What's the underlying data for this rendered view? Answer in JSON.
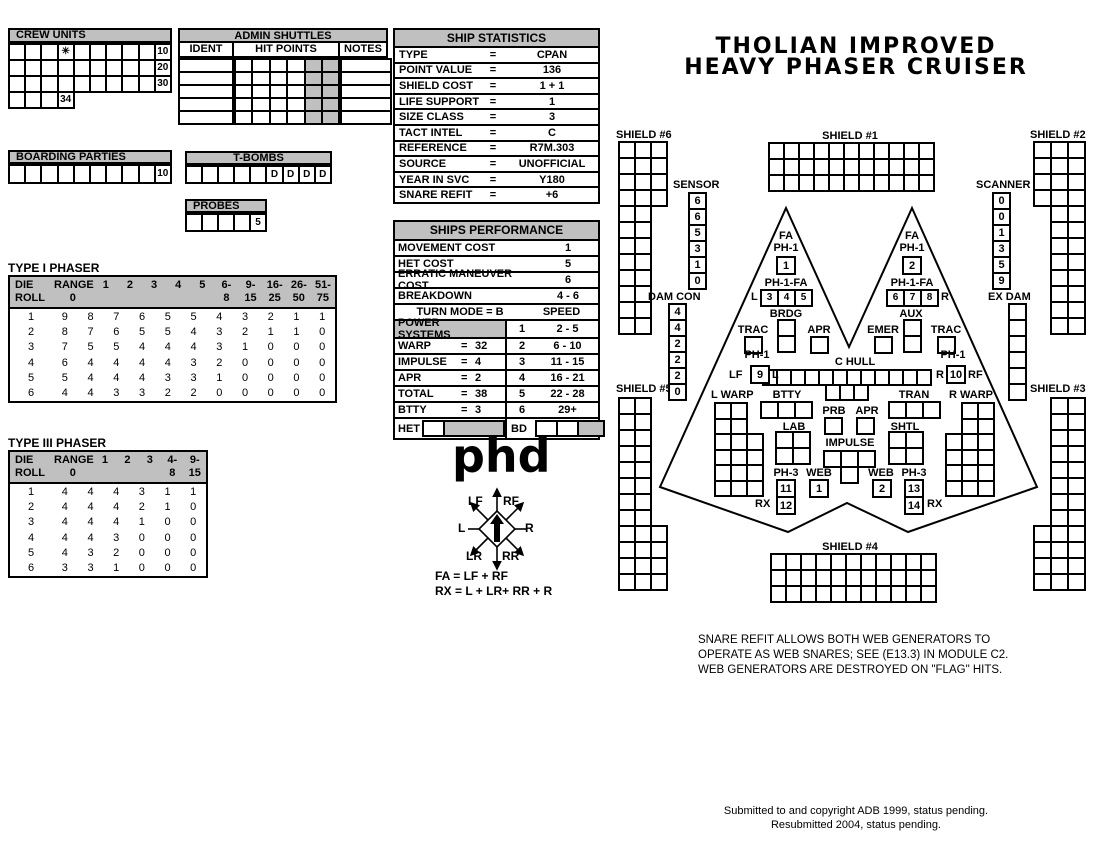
{
  "colors": {
    "panel_gray": "#c0c0c0",
    "ink": "#000000",
    "paper": "#ffffff"
  },
  "title": {
    "line1": "THOLIAN IMPROVED",
    "line2": "HEAVY PHASER CRUISER"
  },
  "crew_units": {
    "label": "CREW UNITS",
    "grid": [
      [
        "",
        "",
        "",
        "✳",
        "",
        "",
        "",
        "",
        "",
        "10"
      ],
      [
        "",
        "",
        "",
        "",
        "",
        "",
        "",
        "",
        "",
        "20"
      ],
      [
        "",
        "",
        "",
        "",
        "",
        "",
        "",
        "",
        "",
        "30"
      ],
      [
        "",
        "",
        "",
        "34"
      ]
    ]
  },
  "admin_shuttles": {
    "label": "ADMIN SHUTTLES",
    "col_ident": "IDENT",
    "col_hits": "HIT POINTS",
    "col_notes": "NOTES",
    "ident_grid": [
      [
        ""
      ],
      [
        ""
      ],
      [
        ""
      ],
      [
        ""
      ],
      [
        ""
      ]
    ],
    "hits_grid": [
      [
        "",
        "",
        "",
        "",
        "#",
        "#"
      ],
      [
        "",
        "",
        "",
        "",
        "#",
        "#"
      ],
      [
        "",
        "",
        "",
        "",
        "#",
        "#"
      ],
      [
        "",
        "",
        "",
        "",
        "#",
        "#"
      ],
      [
        "",
        "",
        "",
        "",
        "#",
        "#"
      ]
    ],
    "notes_grid": [
      [
        ""
      ],
      [
        ""
      ],
      [
        ""
      ],
      [
        ""
      ],
      [
        ""
      ]
    ]
  },
  "boarding_parties": {
    "label": "BOARDING PARTIES",
    "grid": [
      [
        "",
        "",
        "",
        "",
        "",
        "",
        "",
        "",
        "",
        "10"
      ]
    ]
  },
  "t_bombs": {
    "label": "T-BOMBS",
    "grid": [
      [
        "",
        "",
        "",
        "",
        "",
        "D",
        "D",
        "D",
        "D"
      ]
    ]
  },
  "probes": {
    "label": "PROBES",
    "grid": [
      [
        "",
        "",
        "",
        "",
        "5"
      ]
    ]
  },
  "ship_statistics": {
    "label": "SHIP STATISTICS",
    "rows": [
      {
        "label": "TYPE",
        "eq": "=",
        "value": "CPAN"
      },
      {
        "label": "POINT VALUE",
        "eq": "=",
        "value": "136"
      },
      {
        "label": "SHIELD COST",
        "eq": "=",
        "value": "1 + 1"
      },
      {
        "label": "LIFE SUPPORT",
        "eq": "=",
        "value": "1"
      },
      {
        "label": "SIZE CLASS",
        "eq": "=",
        "value": "3"
      },
      {
        "label": "TACT INTEL",
        "eq": "=",
        "value": "C"
      },
      {
        "label": "REFERENCE",
        "eq": "=",
        "value": "R7M.303"
      },
      {
        "label": "SOURCE",
        "eq": "=",
        "value": "UNOFFICIAL"
      },
      {
        "label": "YEAR IN SVC",
        "eq": "=",
        "value": "Y180"
      },
      {
        "label": "SNARE REFIT",
        "eq": "=",
        "value": "+6"
      }
    ]
  },
  "performance": {
    "label": "SHIPS PERFORMANCE",
    "simple_rows": [
      {
        "label": "MOVEMENT COST",
        "value": "1"
      },
      {
        "label": "HET COST",
        "value": "5"
      },
      {
        "label": "ERRATIC MANEUVER COST",
        "value": "6"
      },
      {
        "label": "BREAKDOWN",
        "value": "4 - 6"
      }
    ],
    "turn_mode": "TURN MODE = B",
    "speed_header": "SPEED",
    "power_rows": [
      {
        "label": "POWER SYSTEMS",
        "eq": "",
        "value": "",
        "gray": true
      },
      {
        "label": "WARP",
        "eq": "=",
        "value": "32"
      },
      {
        "label": "IMPULSE",
        "eq": "=",
        "value": "4"
      },
      {
        "label": "APR",
        "eq": "=",
        "value": "2"
      },
      {
        "label": "TOTAL",
        "eq": "=",
        "value": "38"
      },
      {
        "label": "BTTY",
        "eq": "=",
        "value": "3"
      }
    ],
    "speed_rows": [
      {
        "label": "1",
        "value": "2 - 5"
      },
      {
        "label": "2",
        "value": "6 - 10"
      },
      {
        "label": "3",
        "value": "11 - 15"
      },
      {
        "label": "4",
        "value": "16 - 21"
      },
      {
        "label": "5",
        "value": "22 - 28"
      },
      {
        "label": "6",
        "value": "29+"
      }
    ],
    "het_label": "HET",
    "bd_label": "BD",
    "het_cells": [
      [
        "",
        "#"
      ]
    ],
    "bd_cells": [
      [
        "",
        "",
        "#"
      ]
    ]
  },
  "phaser1": {
    "title": "TYPE I PHASER",
    "die_top": "DIE",
    "die_bot": "ROLL",
    "headers": [
      {
        "top": "RANGE",
        "bot": "0"
      },
      {
        "top": "",
        "bot": "1"
      },
      {
        "top": "",
        "bot": "2"
      },
      {
        "top": "",
        "bot": "3"
      },
      {
        "top": "",
        "bot": "4"
      },
      {
        "top": "",
        "bot": "5"
      },
      {
        "top": "6-",
        "bot": "8"
      },
      {
        "top": "9-",
        "bot": "15"
      },
      {
        "top": "16-",
        "bot": "25"
      },
      {
        "top": "26-",
        "bot": "50"
      },
      {
        "top": "51-",
        "bot": "75"
      }
    ],
    "rows": [
      [
        "1",
        "9",
        "8",
        "7",
        "6",
        "5",
        "5",
        "4",
        "3",
        "2",
        "1",
        "1"
      ],
      [
        "2",
        "8",
        "7",
        "6",
        "5",
        "5",
        "4",
        "3",
        "2",
        "1",
        "1",
        "0"
      ],
      [
        "3",
        "7",
        "5",
        "5",
        "4",
        "4",
        "4",
        "3",
        "1",
        "0",
        "0",
        "0"
      ],
      [
        "4",
        "6",
        "4",
        "4",
        "4",
        "4",
        "3",
        "2",
        "0",
        "0",
        "0",
        "0"
      ],
      [
        "5",
        "5",
        "4",
        "4",
        "4",
        "3",
        "3",
        "1",
        "0",
        "0",
        "0",
        "0"
      ],
      [
        "6",
        "4",
        "4",
        "3",
        "3",
        "2",
        "2",
        "0",
        "0",
        "0",
        "0",
        "0"
      ]
    ]
  },
  "phaser3": {
    "title": "TYPE III PHASER",
    "die_top": "DIE",
    "die_bot": "ROLL",
    "headers": [
      {
        "top": "RANGE",
        "bot": "0"
      },
      {
        "top": "",
        "bot": "1"
      },
      {
        "top": "",
        "bot": "2"
      },
      {
        "top": "",
        "bot": "3"
      },
      {
        "top": "4-",
        "bot": "8"
      },
      {
        "top": "9-",
        "bot": "15"
      }
    ],
    "rows": [
      [
        "1",
        "4",
        "4",
        "4",
        "3",
        "1",
        "1"
      ],
      [
        "2",
        "4",
        "4",
        "4",
        "2",
        "1",
        "0"
      ],
      [
        "3",
        "4",
        "4",
        "4",
        "1",
        "0",
        "0"
      ],
      [
        "4",
        "4",
        "4",
        "3",
        "0",
        "0",
        "0"
      ],
      [
        "5",
        "4",
        "3",
        "2",
        "0",
        "0",
        "0"
      ],
      [
        "6",
        "3",
        "3",
        "1",
        "0",
        "0",
        "0"
      ]
    ]
  },
  "phd": {
    "label": "phd",
    "fa_formula": "FA = LF + RF",
    "rx_formula": "RX = L + LR+ RR + R",
    "compass": {
      "lf": "LF",
      "rf": "RF",
      "l": "L",
      "r": "R",
      "lr": "LR",
      "rr": "RR"
    }
  },
  "diagram": {
    "shield1": {
      "label": "SHIELD #1",
      "grid": [
        [
          "",
          "",
          "",
          "",
          "",
          "",
          "",
          "",
          "",
          "",
          ""
        ],
        [
          "",
          "",
          "",
          "",
          "",
          "",
          "",
          "",
          "",
          "",
          ""
        ],
        [
          "",
          "",
          "",
          "",
          "",
          "",
          "",
          "",
          "",
          "",
          ""
        ]
      ]
    },
    "shield2": {
      "label": "SHIELD #2",
      "grid": [
        [
          "",
          "",
          ""
        ],
        [
          "",
          "",
          ""
        ],
        [
          "",
          "",
          ""
        ],
        [
          "",
          "",
          ""
        ],
        {
          "align": "right",
          "cells": [
            "",
            ""
          ]
        },
        {
          "align": "right",
          "cells": [
            "",
            ""
          ]
        },
        {
          "align": "right",
          "cells": [
            "",
            ""
          ]
        },
        {
          "align": "right",
          "cells": [
            "",
            ""
          ]
        },
        {
          "align": "right",
          "cells": [
            "",
            ""
          ]
        },
        {
          "align": "right",
          "cells": [
            "",
            ""
          ]
        },
        {
          "align": "right",
          "cells": [
            "",
            ""
          ]
        },
        {
          "align": "right",
          "cells": [
            "",
            ""
          ]
        }
      ]
    },
    "shield3": {
      "label": "SHIELD #3",
      "grid": [
        {
          "align": "right",
          "cells": [
            "",
            ""
          ]
        },
        {
          "align": "right",
          "cells": [
            "",
            ""
          ]
        },
        {
          "align": "right",
          "cells": [
            "",
            ""
          ]
        },
        {
          "align": "right",
          "cells": [
            "",
            ""
          ]
        },
        {
          "align": "right",
          "cells": [
            "",
            ""
          ]
        },
        {
          "align": "right",
          "cells": [
            "",
            ""
          ]
        },
        {
          "align": "right",
          "cells": [
            "",
            ""
          ]
        },
        {
          "align": "right",
          "cells": [
            "",
            ""
          ]
        },
        [
          "",
          "",
          ""
        ],
        [
          "",
          "",
          ""
        ],
        [
          "",
          "",
          ""
        ],
        [
          "",
          "",
          ""
        ]
      ]
    },
    "shield4": {
      "label": "SHIELD #4",
      "grid": [
        [
          "",
          "",
          "",
          "",
          "",
          "",
          "",
          "",
          "",
          "",
          ""
        ],
        [
          "",
          "",
          "",
          "",
          "",
          "",
          "",
          "",
          "",
          "",
          ""
        ],
        [
          "",
          "",
          "",
          "",
          "",
          "",
          "",
          "",
          "",
          "",
          ""
        ]
      ]
    },
    "shield5": {
      "label": "SHIELD #5",
      "grid": [
        [
          "",
          ""
        ],
        [
          "",
          ""
        ],
        [
          "",
          ""
        ],
        [
          "",
          ""
        ],
        [
          "",
          ""
        ],
        [
          "",
          ""
        ],
        [
          "",
          ""
        ],
        [
          "",
          ""
        ],
        [
          "",
          "",
          ""
        ],
        [
          "",
          "",
          ""
        ],
        [
          "",
          "",
          ""
        ],
        [
          "",
          "",
          ""
        ]
      ]
    },
    "shield6": {
      "label": "SHIELD #6",
      "grid": [
        [
          "",
          "",
          ""
        ],
        [
          "",
          "",
          ""
        ],
        [
          "",
          "",
          ""
        ],
        [
          "",
          "",
          ""
        ],
        [
          "",
          ""
        ],
        [
          "",
          ""
        ],
        [
          "",
          ""
        ],
        [
          "",
          ""
        ],
        [
          "",
          ""
        ],
        [
          "",
          ""
        ],
        [
          "",
          ""
        ],
        [
          "",
          ""
        ]
      ]
    },
    "sensor": {
      "label": "SENSOR",
      "grid": [
        [
          "6"
        ],
        [
          "6"
        ],
        [
          "5"
        ],
        [
          "3"
        ],
        [
          "1"
        ],
        [
          "0"
        ]
      ]
    },
    "scanner": {
      "label": "SCANNER",
      "grid": [
        [
          "0"
        ],
        [
          "0"
        ],
        [
          "1"
        ],
        [
          "3"
        ],
        [
          "5"
        ],
        [
          "9"
        ]
      ]
    },
    "dam_con": {
      "label": "DAM CON",
      "grid": [
        [
          "4"
        ],
        [
          "4"
        ],
        [
          "2"
        ],
        [
          "2"
        ],
        [
          "2"
        ],
        [
          "0"
        ]
      ]
    },
    "ex_dam": {
      "label": "EX DAM",
      "grid": [
        [
          ""
        ],
        [
          ""
        ],
        [
          ""
        ],
        [
          ""
        ],
        [
          ""
        ],
        [
          ""
        ]
      ]
    },
    "fa_left": {
      "label1": "FA",
      "label2": "PH-1",
      "grid": [
        [
          "1"
        ]
      ]
    },
    "fa_right": {
      "label1": "FA",
      "label2": "PH-1",
      "grid": [
        [
          "2"
        ]
      ]
    },
    "ph1fa_left": {
      "label": "PH-1-FA",
      "side": "L",
      "grid": [
        [
          "3",
          "4",
          "5"
        ]
      ]
    },
    "ph1fa_right": {
      "label": "PH-1-FA",
      "side": "R",
      "grid": [
        [
          "6",
          "7",
          "8"
        ]
      ]
    },
    "brdg": {
      "label": "BRDG",
      "grid": [
        [
          ""
        ],
        [
          ""
        ]
      ]
    },
    "aux": {
      "label": "AUX",
      "grid": [
        [
          ""
        ],
        [
          ""
        ]
      ]
    },
    "trac_left": {
      "label": "TRAC",
      "grid": [
        [
          ""
        ]
      ]
    },
    "trac_right": {
      "label": "TRAC",
      "grid": [
        [
          ""
        ]
      ]
    },
    "apr_top": {
      "label": "APR",
      "grid": [
        [
          ""
        ]
      ]
    },
    "emer": {
      "label": "EMER",
      "grid": [
        [
          ""
        ]
      ]
    },
    "c_hull": {
      "label": "C HULL",
      "grid": [
        [
          "",
          "",
          "",
          "",
          "",
          "",
          "",
          "",
          "",
          "",
          "",
          ""
        ],
        {
          "align": "center",
          "cells": [
            "",
            "",
            ""
          ]
        }
      ]
    },
    "ph1_waist_left": {
      "label": "PH-1",
      "pre": "LF",
      "post": "L",
      "grid": [
        [
          "9"
        ]
      ]
    },
    "ph1_waist_right": {
      "label": "PH-1",
      "pre": "R",
      "post": "RF",
      "grid": [
        [
          "10"
        ]
      ]
    },
    "l_warp": {
      "label": "L WARP",
      "grid": [
        [
          "",
          ""
        ],
        [
          "",
          ""
        ],
        [
          "",
          "",
          ""
        ],
        [
          "",
          "",
          ""
        ],
        [
          "",
          "",
          ""
        ],
        [
          "",
          "",
          ""
        ]
      ]
    },
    "r_warp": {
      "label": "R WARP",
      "grid": [
        {
          "align": "right",
          "cells": [
            "",
            ""
          ]
        },
        {
          "align": "right",
          "cells": [
            "",
            ""
          ]
        },
        [
          "",
          "",
          ""
        ],
        [
          "",
          "",
          ""
        ],
        [
          "",
          "",
          ""
        ],
        [
          "",
          "",
          ""
        ]
      ]
    },
    "btty": {
      "label": "BTTY",
      "grid": [
        [
          "",
          "",
          ""
        ]
      ]
    },
    "tran": {
      "label": "TRAN",
      "grid": [
        [
          "",
          "",
          ""
        ]
      ]
    },
    "lab": {
      "label": "LAB",
      "grid": [
        [
          "",
          ""
        ],
        [
          "",
          ""
        ]
      ]
    },
    "shtl": {
      "label": "SHTL",
      "grid": [
        [
          "",
          ""
        ],
        [
          "",
          ""
        ]
      ]
    },
    "prb": {
      "label": "PRB",
      "grid": [
        [
          ""
        ]
      ]
    },
    "apr_bottom": {
      "label": "APR",
      "grid": [
        [
          ""
        ]
      ]
    },
    "impulse": {
      "label": "IMPULSE",
      "grid": [
        [
          "",
          "",
          ""
        ],
        {
          "align": "center",
          "cells": [
            ""
          ]
        }
      ]
    },
    "ph3_left": {
      "label": "PH-3",
      "rx": "RX",
      "grid": [
        [
          "11"
        ],
        [
          "12"
        ]
      ]
    },
    "ph3_right": {
      "label": "PH-3",
      "rx": "RX",
      "grid": [
        [
          "13"
        ],
        [
          "14"
        ]
      ]
    },
    "web_left": {
      "label": "WEB",
      "grid": [
        [
          "1"
        ]
      ]
    },
    "web_right": {
      "label": "WEB",
      "grid": [
        [
          "2"
        ]
      ]
    },
    "note_lines": [
      "SNARE REFIT ALLOWS BOTH WEB GENERATORS TO",
      "OPERATE AS WEB SNARES; SEE (E13.3) IN MODULE C2.",
      "WEB GENERATORS ARE DESTROYED ON \"FLAG\" HITS."
    ]
  },
  "footer": {
    "line1": "Submitted to and copyright ADB 1999, status pending.",
    "line2": "Resubmitted 2004, status pending."
  }
}
